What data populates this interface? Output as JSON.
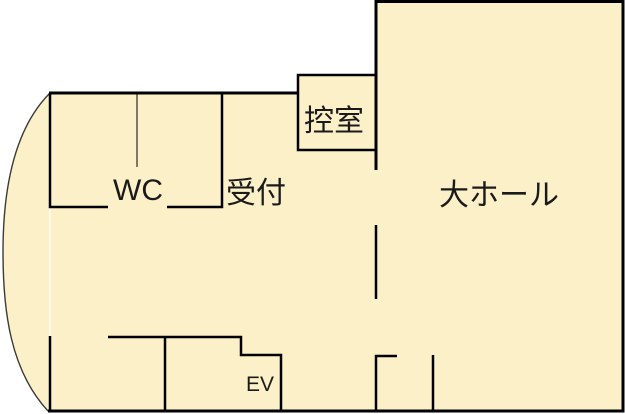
{
  "rooms": {
    "wc": {
      "label": "WC"
    },
    "reception": {
      "label": "受付"
    },
    "waiting_room": {
      "label": "控室"
    },
    "main_hall": {
      "label": "大ホール"
    },
    "elevator": {
      "label": "EV"
    }
  },
  "colors": {
    "floor": "#FCF0C8",
    "wall": "#000000",
    "outside": "#FFFFFF",
    "curve": "#3A3A3A"
  }
}
